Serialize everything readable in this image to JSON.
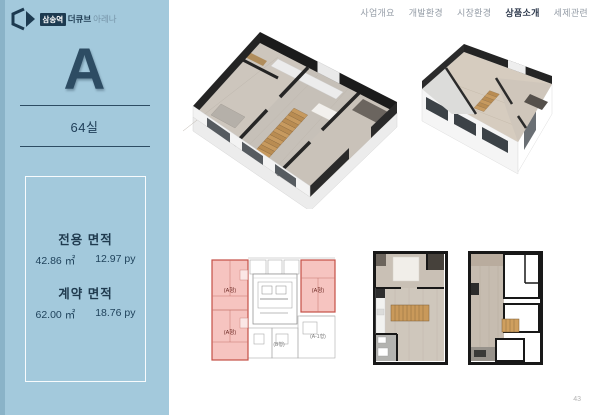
{
  "page": {
    "number": "43"
  },
  "logo": {
    "badge": "삼송역",
    "name_bold": "더큐브",
    "name_light": "아레나"
  },
  "nav": {
    "items": [
      "사업개요",
      "개발환경",
      "시장환경",
      "상품소개",
      "세제관련"
    ],
    "active": "상품소개"
  },
  "sidebar": {
    "type_letter": "A",
    "room_count": "64실",
    "area_box": {
      "exclusive": {
        "label": "전용 면적",
        "m2": "42.86 ㎡",
        "py": "12.97 py"
      },
      "contract": {
        "label": "계약 면적",
        "m2": "62.00 ㎡",
        "py": "18.76 py"
      }
    }
  },
  "floor_plate": {
    "unit_a_left_top": "(A형)",
    "unit_a_left_bottom": "(A형)",
    "unit_a_right": "(A형)",
    "unit_b": "(B형)",
    "unit_a1": "(A-1형)"
  },
  "colors": {
    "sidebar_bg": "#a3c9dc",
    "accent_navy": "#2d4c63",
    "highlight_red": "#c44f46",
    "wall_dark": "#1e1e1e",
    "wood": "#c79a5f"
  }
}
